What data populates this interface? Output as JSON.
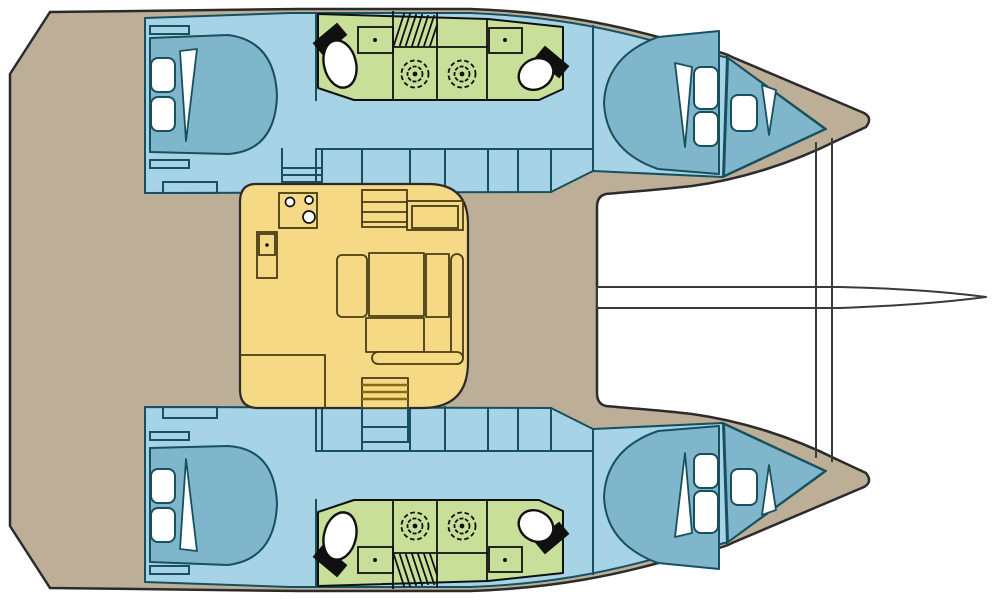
{
  "title": "Catamaran interior layout floor plan (4 cabins, 4 shower rooms)",
  "palette": {
    "background": "#ffffff",
    "deck": "#bdae97",
    "hull": "#a6d3e6",
    "berth": "#7fb6cc",
    "wetroom": "#c8df9a",
    "salon": "#f6d985",
    "outline": "#2b2b2b",
    "wall": "#17505f",
    "fixture": "#101010",
    "salon_line": "#4a3c14",
    "tread": "#8a6c10"
  },
  "regions": {
    "deck": "aft cockpit and side decks",
    "salon": "saloon with galley, dinette and companionway steps",
    "hulls": "two hulls, each with double berth cabins fore and aft",
    "wet_rooms": "two shower rooms with toilet and washbasin per hull",
    "foredeck": "forward deck with bowsprit and bridle lines"
  },
  "counts": {
    "hulls": 2,
    "berth_cabins": 4,
    "toilets": 4,
    "showers": 4,
    "washbasins": 4
  }
}
